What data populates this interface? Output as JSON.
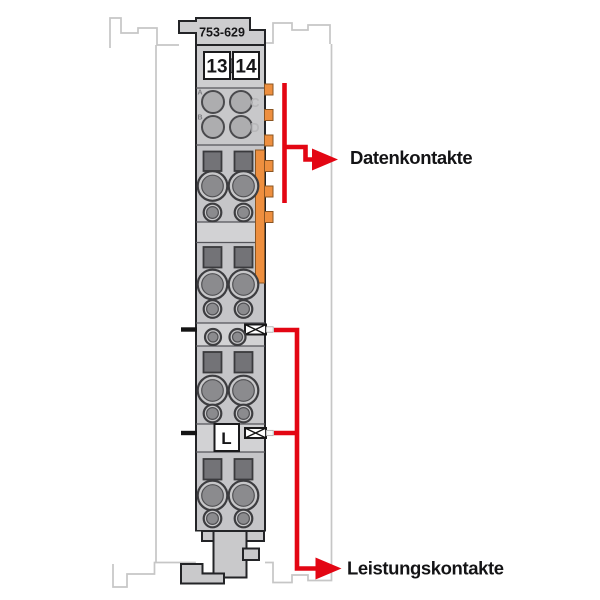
{
  "module": {
    "part_number": "753-629",
    "terminal_numbers": [
      "13",
      "14"
    ],
    "data_port_labels": [
      "A",
      "B",
      "C",
      "D"
    ],
    "power_terminal_label": "L"
  },
  "annotations": {
    "data_contacts": "Datenkontakte",
    "power_contacts": "Leistungskontakte"
  },
  "colors": {
    "annotation_red": "#e30613",
    "contact_orange": "#ee8f3f",
    "module_body_gray": "#cdcdcf",
    "ghost_outline_gray": "#c6c6c6"
  }
}
